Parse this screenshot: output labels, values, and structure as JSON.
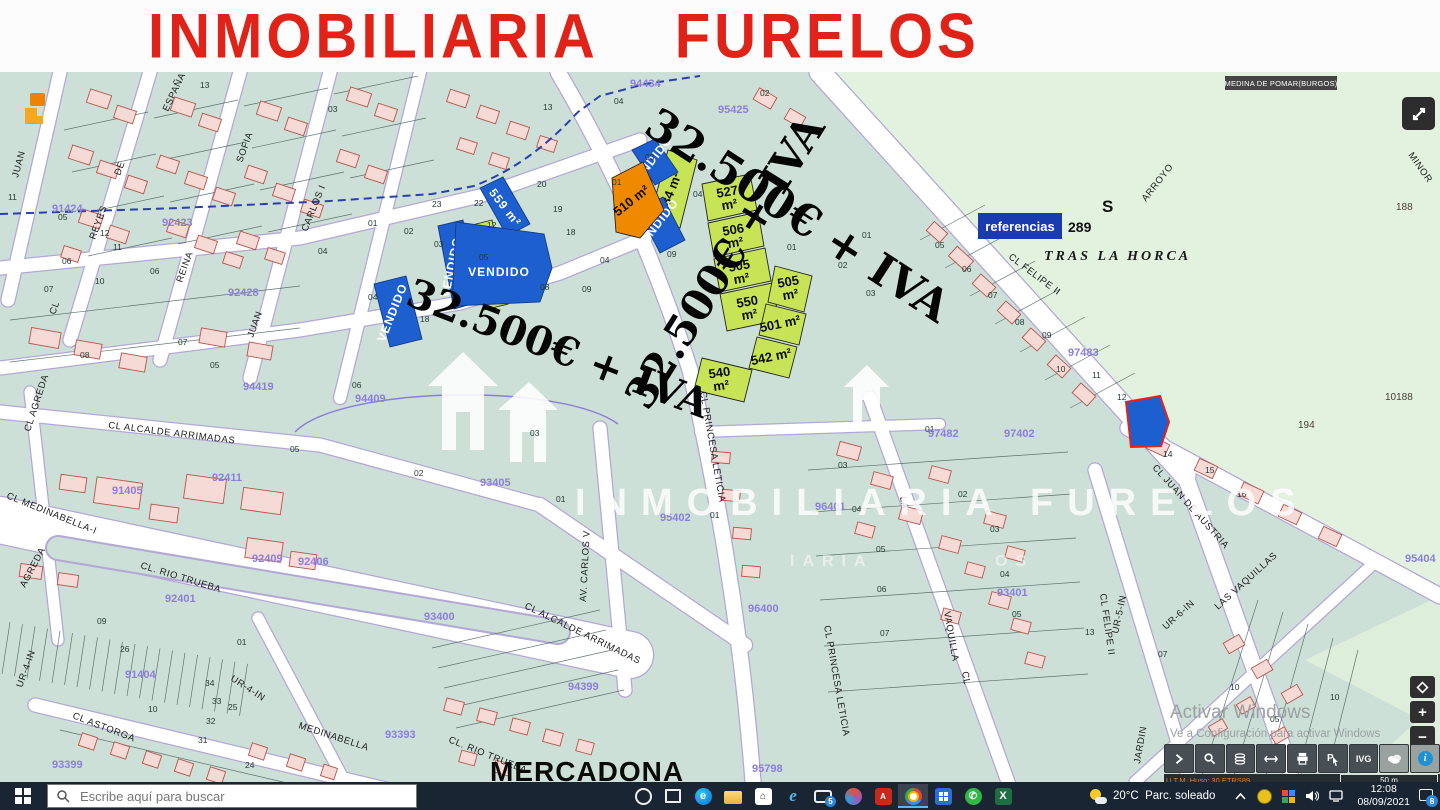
{
  "banner": {
    "title": "INMOBILIARIA  FURELOS"
  },
  "map": {
    "municipality_label": "MEDINA DE POMAR(BURGOS)",
    "prices": [
      {
        "t": "32.500€ + IVA",
        "x": 642,
        "y": 132,
        "r": 33,
        "s": 44
      },
      {
        "t": "32.500€ + IVA",
        "x": 648,
        "y": 412,
        "r": -58,
        "s": 42
      },
      {
        "t": "32.500€ + IVA",
        "x": 404,
        "y": 304,
        "r": 21,
        "s": 40
      }
    ],
    "streets": [
      {
        "t": "JUAN",
        "x": 18,
        "y": 178,
        "r": -75
      },
      {
        "t": "ESPAÑA",
        "x": 168,
        "y": 112,
        "r": -65
      },
      {
        "t": "DE",
        "x": 120,
        "y": 176,
        "r": -70
      },
      {
        "t": "SOFIA",
        "x": 242,
        "y": 163,
        "r": -70
      },
      {
        "t": "REYES",
        "x": 95,
        "y": 240,
        "r": -70
      },
      {
        "t": "REINA",
        "x": 182,
        "y": 283,
        "r": -70
      },
      {
        "t": "JUAN",
        "x": 253,
        "y": 338,
        "r": -70
      },
      {
        "t": "CARLOS I",
        "x": 307,
        "y": 232,
        "r": -68
      },
      {
        "t": "CL",
        "x": 55,
        "y": 315,
        "r": -70
      },
      {
        "t": "CL AGREDA",
        "x": 30,
        "y": 432,
        "r": -72
      },
      {
        "t": "AGREDA",
        "x": 25,
        "y": 588,
        "r": -62
      },
      {
        "t": "CL MEDINABELLA-I",
        "x": 6,
        "y": 498,
        "r": 22
      },
      {
        "t": "CL. RIO TRUEBA",
        "x": 140,
        "y": 568,
        "r": 17
      },
      {
        "t": "CL. RIO TRUEBA",
        "x": 448,
        "y": 742,
        "r": 22
      },
      {
        "t": "CL ASTORGA",
        "x": 72,
        "y": 718,
        "r": 21
      },
      {
        "t": "MEDINABELLA",
        "x": 298,
        "y": 728,
        "r": 18
      },
      {
        "t": "CL ALCALDE ARRIMADAS",
        "x": 108,
        "y": 428,
        "r": 7
      },
      {
        "t": "CL ALCALDE ARRIMADAS",
        "x": 524,
        "y": 608,
        "r": 26
      },
      {
        "t": "AV. CARLOS V",
        "x": 586,
        "y": 602,
        "r": -87
      },
      {
        "t": "CL PRINCESA LETICIA",
        "x": 700,
        "y": 392,
        "r": 80
      },
      {
        "t": "CL PRINCESA LETICIA",
        "x": 824,
        "y": 626,
        "r": 80
      },
      {
        "t": "LA",
        "x": 900,
        "y": 497,
        "r": 80
      },
      {
        "t": "VAQUILLA",
        "x": 944,
        "y": 612,
        "r": 80
      },
      {
        "t": "CL",
        "x": 962,
        "y": 672,
        "r": 80
      },
      {
        "t": "CL FELIPE II",
        "x": 1008,
        "y": 258,
        "r": 37
      },
      {
        "t": "CL FELIPE II",
        "x": 1100,
        "y": 594,
        "r": 82
      },
      {
        "t": "CL JUAN DE AUSTRIA",
        "x": 1152,
        "y": 468,
        "r": 48
      },
      {
        "t": "UR-4-IN",
        "x": 230,
        "y": 680,
        "r": 33
      },
      {
        "t": "UR-4-IN",
        "x": 22,
        "y": 688,
        "r": -70
      },
      {
        "t": "UR-5-IN",
        "x": 1118,
        "y": 634,
        "r": -78
      },
      {
        "t": "LAS VAQUILLAS",
        "x": 1218,
        "y": 610,
        "r": -42
      },
      {
        "t": "UR-6-IN",
        "x": 1166,
        "y": 630,
        "r": -42
      },
      {
        "t": "JARDIN",
        "x": 1140,
        "y": 764,
        "r": -80
      },
      {
        "t": "ARROYO",
        "x": 1146,
        "y": 202,
        "r": -52
      },
      {
        "t": "MINOR",
        "x": 1408,
        "y": 155,
        "r": 55,
        "c": "#a03a30"
      }
    ],
    "refs": [
      [
        "91424",
        52,
        212
      ],
      [
        "92423",
        162,
        226
      ],
      [
        "92428",
        228,
        296
      ],
      [
        "94434",
        630,
        87
      ],
      [
        "95425",
        718,
        113
      ],
      [
        "94419",
        243,
        390
      ],
      [
        "94409",
        355,
        402
      ],
      [
        "93405",
        480,
        486
      ],
      [
        "95402",
        660,
        521
      ],
      [
        "96401",
        815,
        510
      ],
      [
        "97482",
        928,
        437
      ],
      [
        "97402",
        1004,
        437
      ],
      [
        "93401",
        997,
        596
      ],
      [
        "97483",
        1068,
        356
      ],
      [
        "95404",
        1405,
        562
      ],
      [
        "91405",
        112,
        494
      ],
      [
        "92411",
        212,
        481
      ],
      [
        "92409",
        252,
        562
      ],
      [
        "92406",
        298,
        565
      ],
      [
        "92401",
        165,
        602
      ],
      [
        "91404",
        125,
        678
      ],
      [
        "93400",
        424,
        620
      ],
      [
        "93399",
        52,
        768
      ],
      [
        "93393",
        385,
        738
      ],
      [
        "94399",
        568,
        690
      ],
      [
        "96400",
        748,
        612
      ],
      [
        "95798",
        752,
        772
      ]
    ],
    "nums": [
      [
        "13",
        200,
        88
      ],
      [
        "03",
        328,
        112
      ],
      [
        "04",
        614,
        104
      ],
      [
        "02",
        760,
        96
      ],
      [
        "12",
        100,
        236
      ],
      [
        "04",
        318,
        254
      ],
      [
        "13",
        543,
        110
      ],
      [
        "03",
        645,
        160
      ],
      [
        "12",
        487,
        228
      ],
      [
        "04",
        600,
        263
      ],
      [
        "11",
        8,
        200
      ],
      [
        "05",
        58,
        220
      ],
      [
        "06",
        62,
        264
      ],
      [
        "07",
        44,
        292
      ],
      [
        "10",
        95,
        284
      ],
      [
        "11",
        113,
        250
      ],
      [
        "06",
        150,
        274
      ],
      [
        "08",
        80,
        358
      ],
      [
        "07",
        178,
        345
      ],
      [
        "05",
        210,
        368
      ],
      [
        "01",
        862,
        238
      ],
      [
        "02",
        838,
        268
      ],
      [
        "03",
        866,
        296
      ],
      [
        "23",
        432,
        207
      ],
      [
        "22",
        474,
        206
      ],
      [
        "20",
        537,
        187
      ],
      [
        "19",
        553,
        212
      ],
      [
        "18",
        566,
        235
      ],
      [
        "01",
        368,
        226
      ],
      [
        "02",
        404,
        234
      ],
      [
        "03",
        434,
        247
      ],
      [
        "05",
        479,
        260
      ],
      [
        "04",
        368,
        300
      ],
      [
        "18",
        420,
        322
      ],
      [
        "08",
        540,
        290
      ],
      [
        "09",
        582,
        292
      ],
      [
        "04",
        693,
        197
      ],
      [
        "09",
        667,
        257
      ],
      [
        "01",
        787,
        250
      ],
      [
        "01",
        612,
        185
      ],
      [
        "06",
        352,
        388
      ],
      [
        "02",
        414,
        476
      ],
      [
        "01",
        556,
        502
      ],
      [
        "03",
        530,
        436
      ],
      [
        "05",
        290,
        452
      ],
      [
        "01",
        710,
        518
      ],
      [
        "26",
        120,
        652
      ],
      [
        "25",
        228,
        710
      ],
      [
        "01",
        237,
        645
      ],
      [
        "09",
        97,
        624
      ],
      [
        "10",
        148,
        712
      ],
      [
        "34",
        205,
        686
      ],
      [
        "33",
        212,
        704
      ],
      [
        "32",
        206,
        724
      ],
      [
        "31",
        198,
        743
      ],
      [
        "24",
        245,
        768
      ],
      [
        "05",
        935,
        248
      ],
      [
        "06",
        962,
        272
      ],
      [
        "07",
        988,
        298
      ],
      [
        "08",
        1015,
        325
      ],
      [
        "09",
        1042,
        338
      ],
      [
        "10",
        1056,
        372
      ],
      [
        "11",
        1092,
        378
      ],
      [
        "12",
        1117,
        400
      ],
      [
        "14",
        1163,
        457
      ],
      [
        "15",
        1205,
        473
      ],
      [
        "16",
        1237,
        497
      ],
      [
        "01",
        925,
        432
      ],
      [
        "03",
        838,
        468
      ],
      [
        "04",
        852,
        512
      ],
      [
        "05",
        876,
        552
      ],
      [
        "06",
        877,
        592
      ],
      [
        "07",
        880,
        636
      ],
      [
        "02",
        958,
        497
      ],
      [
        "03",
        990,
        532
      ],
      [
        "04",
        1000,
        577
      ],
      [
        "05",
        1012,
        617
      ],
      [
        "13",
        1085,
        635
      ],
      [
        "07",
        1158,
        657
      ],
      [
        "10",
        1230,
        690
      ],
      [
        "04",
        1243,
        752
      ],
      [
        "05",
        1270,
        722
      ],
      [
        "10",
        1330,
        700
      ]
    ],
    "land_nums": [
      [
        "194",
        1298,
        428
      ],
      [
        "188",
        1396,
        210
      ],
      [
        "10188",
        1385,
        400
      ]
    ],
    "referencias": {
      "label": "referencias",
      "value": "289"
    },
    "sale_plots": [
      {
        "t": "534 m²",
        "pts": "650,218 668,150 697,160 680,228",
        "lx": 674,
        "ly": 194,
        "r": -68
      },
      {
        "t": "527",
        "t2": "m²",
        "pts": "702,184 750,174 757,210 708,221",
        "lx": 728,
        "ly": 196,
        "r": -10
      },
      {
        "t": "506",
        "t2": "m²",
        "pts": "708,223 758,212 764,246 714,257",
        "lx": 734,
        "ly": 234,
        "r": -10
      },
      {
        "t": "505",
        "t2": "m²",
        "pts": "714,259 765,248 771,281 720,292",
        "lx": 740,
        "ly": 270,
        "r": -10
      },
      {
        "t": "550",
        "t2": "m²",
        "pts": "720,294 772,283 779,320 727,331",
        "lx": 748,
        "ly": 306,
        "r": -10
      },
      {
        "t": "505",
        "t2": "m²",
        "pts": "775,266 812,276 804,312 768,302",
        "lx": 789,
        "ly": 286,
        "r": -10
      },
      {
        "t": "501 m²",
        "pts": "766,304 806,314 799,345 759,335",
        "lx": 781,
        "ly": 328,
        "r": -12
      },
      {
        "t": "542 m²",
        "pts": "757,337 797,347 789,378 749,368",
        "lx": 772,
        "ly": 361,
        "r": -12
      },
      {
        "t": "540",
        "t2": "m²",
        "pts": "702,358 752,370 744,402 694,390",
        "lx": 720,
        "ly": 377,
        "r": -8
      },
      {
        "t": "",
        "pts": "468,226 492,220 508,304 484,310"
      }
    ],
    "vendido_plots": [
      {
        "t": "559 m²",
        "pts": "480,188 503,177 530,224 507,236",
        "lx": 502,
        "ly": 210,
        "r": 52
      },
      {
        "t": "VENDIDO",
        "pts": "438,226 463,220 478,302 454,309",
        "lx": 455,
        "ly": 268,
        "r": -78
      },
      {
        "t": "VENDIDO",
        "pts": "456,222 544,234 552,268 540,302 452,306",
        "lx": 499,
        "ly": 276,
        "r": 0
      },
      {
        "t": "VENDIDO",
        "pts": "374,284 406,276 422,339 390,347",
        "lx": 396,
        "ly": 314,
        "r": -68
      },
      {
        "t": "VENDIDO",
        "pts": "632,150 655,139 678,172 655,185",
        "lx": 654,
        "ly": 164,
        "r": -52
      },
      {
        "t": "VENDIDO",
        "pts": "638,210 663,197 685,240 660,253",
        "lx": 660,
        "ly": 227,
        "r": -52
      },
      {
        "t": "",
        "pts": "1126,402 1160,396 1169,422 1161,446 1131,447",
        "red": true
      }
    ],
    "orange_plot": {
      "t": "510 m²",
      "pts": "612,178 643,162 664,210 640,238 616,232",
      "lx": 634,
      "ly": 204,
      "r": -38
    },
    "watermark": {
      "text": "INMOBILIARIA FURELOS",
      "sub1": "IARIA",
      "sub2": "OS"
    },
    "places": {
      "tras_la_horca": {
        "t": "TRAS LA HORCA",
        "x": 1044,
        "y": 260
      },
      "s_mark": {
        "t": "S",
        "x": 1102,
        "y": 212
      },
      "mercadona": {
        "t": "MERCADONA",
        "x": 490,
        "y": 781
      }
    }
  },
  "viewer": {
    "utm": "U.T.M. Huso: 30 ETRS89",
    "scale": "50 m",
    "ivg": "IVG",
    "activar": {
      "l1": "Activar Windows",
      "l2": "Ve a Configuración para activar Windows"
    }
  },
  "taskbar": {
    "search_placeholder": "Escribe aquí para buscar",
    "weather": {
      "temp": "20°C",
      "cond": "Parc. soleado"
    },
    "clock": {
      "time": "12:08",
      "date": "08/09/2021"
    },
    "notif_badge": "8",
    "mail_badge": "5",
    "icons": [
      "cortana",
      "view",
      "edge",
      "folder",
      "store",
      "ie",
      "mail",
      "paint",
      "pdf",
      "chrome",
      "tiles",
      "whatsapp",
      "excel"
    ]
  },
  "colors": {
    "banner_red": "#e02318",
    "plot_green": "#c6e455",
    "sold_blue": "#1e5fd0",
    "plot_orange": "#ef8a00",
    "urban_teal": "#cde0d7",
    "rustic_green": "#e2f2df",
    "ref_purple": "#8b7fdb",
    "highlight_red": "#e0241c"
  }
}
